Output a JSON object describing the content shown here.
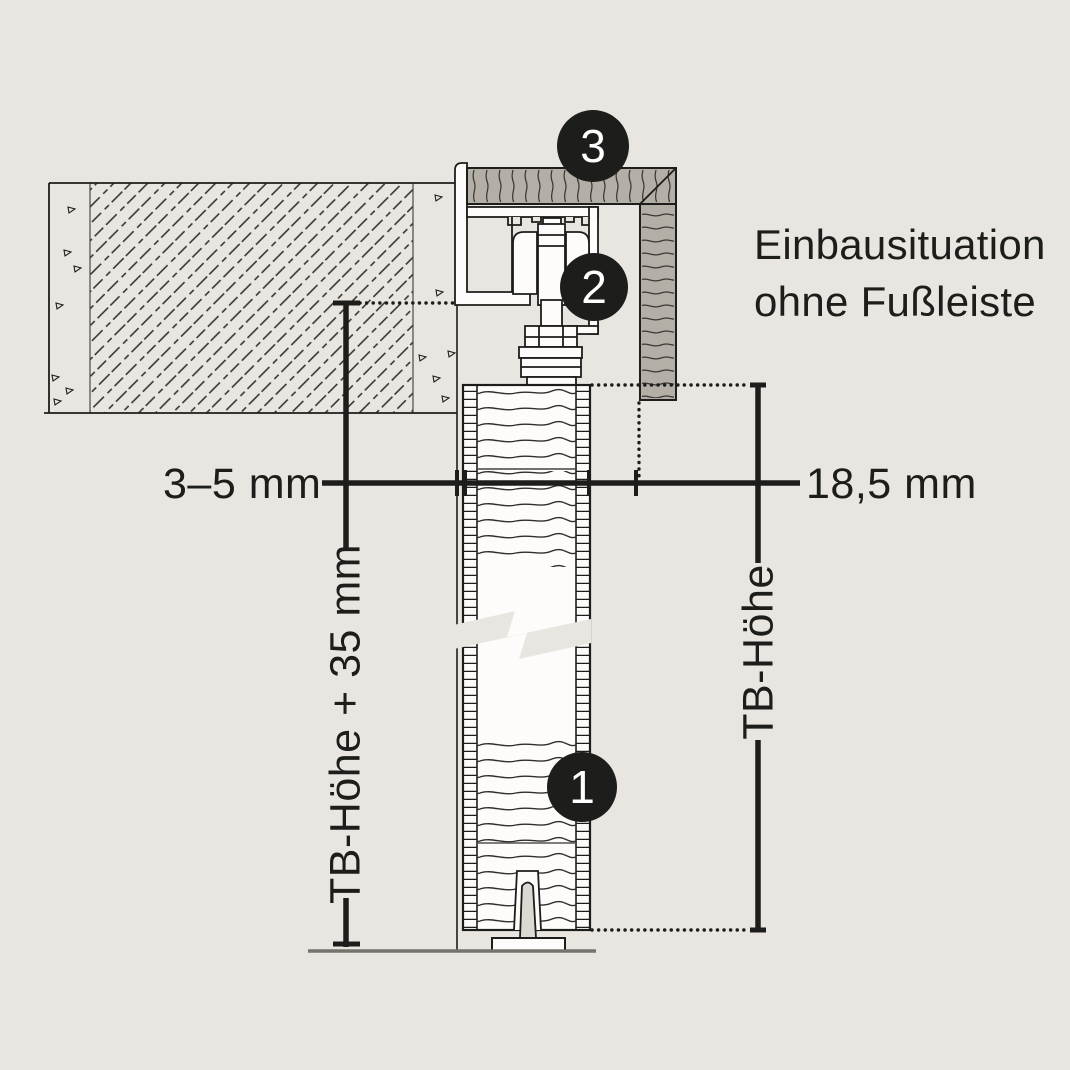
{
  "drawing": {
    "title": {
      "line1": "Einbausituation",
      "line2": "ohne Fußleiste"
    },
    "dimensions": {
      "wall_gap": "3–5 mm",
      "fascia_gap": "18,5 mm",
      "total_height": "TB-Höhe + 35 mm",
      "door_height": "TB-Höhe"
    },
    "markers": {
      "door": "1",
      "trolley": "2",
      "fascia": "3"
    },
    "colors": {
      "background": "#e9e6e1",
      "paper_white": "#fdfcfa",
      "wood_fill": "#b3afa7",
      "line": "#1d1d1b",
      "floor": "#76736f",
      "marker_background": "#1d1d1b",
      "marker_number": "#ffffff"
    }
  }
}
